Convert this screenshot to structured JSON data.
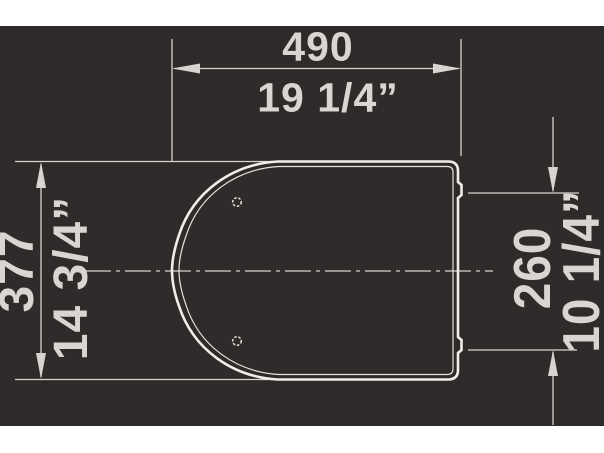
{
  "drawing_title": "toilet-seat plan-view dimension drawing",
  "colors": {
    "page_background": "#ffffff",
    "canvas_background": "#2e2b2a",
    "dimension_lines": "#d8d4d0",
    "dimension_text": "#d9d5d1",
    "seat_outline": "#f1eeea"
  },
  "dimensions": {
    "width": {
      "mm": "490",
      "inch": "19 1/4”"
    },
    "depth": {
      "mm": "377",
      "inch": "14 3/4”"
    },
    "hinge": {
      "mm": "260",
      "inch": "10 1/4”"
    }
  }
}
